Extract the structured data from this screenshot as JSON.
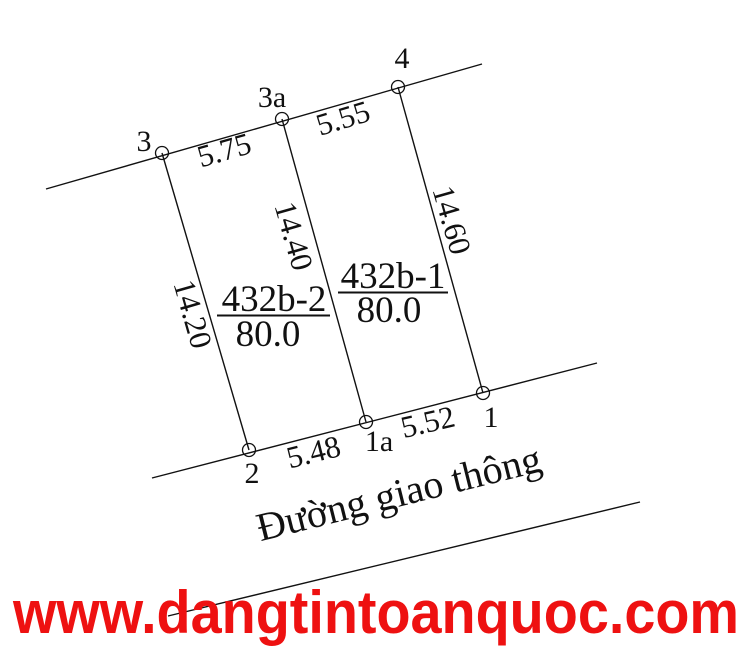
{
  "diagram": {
    "points": {
      "p3": "3",
      "p3a": "3a",
      "p4": "4",
      "p2": "2",
      "p1a": "1a",
      "p1": "1"
    },
    "edge_dims": {
      "top_left": "5.75",
      "top_right": "5.55",
      "bottom_left": "5.48",
      "bottom_right": "5.52",
      "side_left": "14.20",
      "side_middle": "14.40",
      "side_right": "14.60"
    },
    "parcels": {
      "left": {
        "id": "432b-2",
        "area": "80.0"
      },
      "right": {
        "id": "432b-1",
        "area": "80.0"
      }
    },
    "road_label": "Đường giao thông"
  },
  "watermark": {
    "text": "www.dangtintoanquoc.com",
    "color": "#ee1111"
  },
  "colors": {
    "ink": "#111111",
    "background": "#ffffff"
  }
}
